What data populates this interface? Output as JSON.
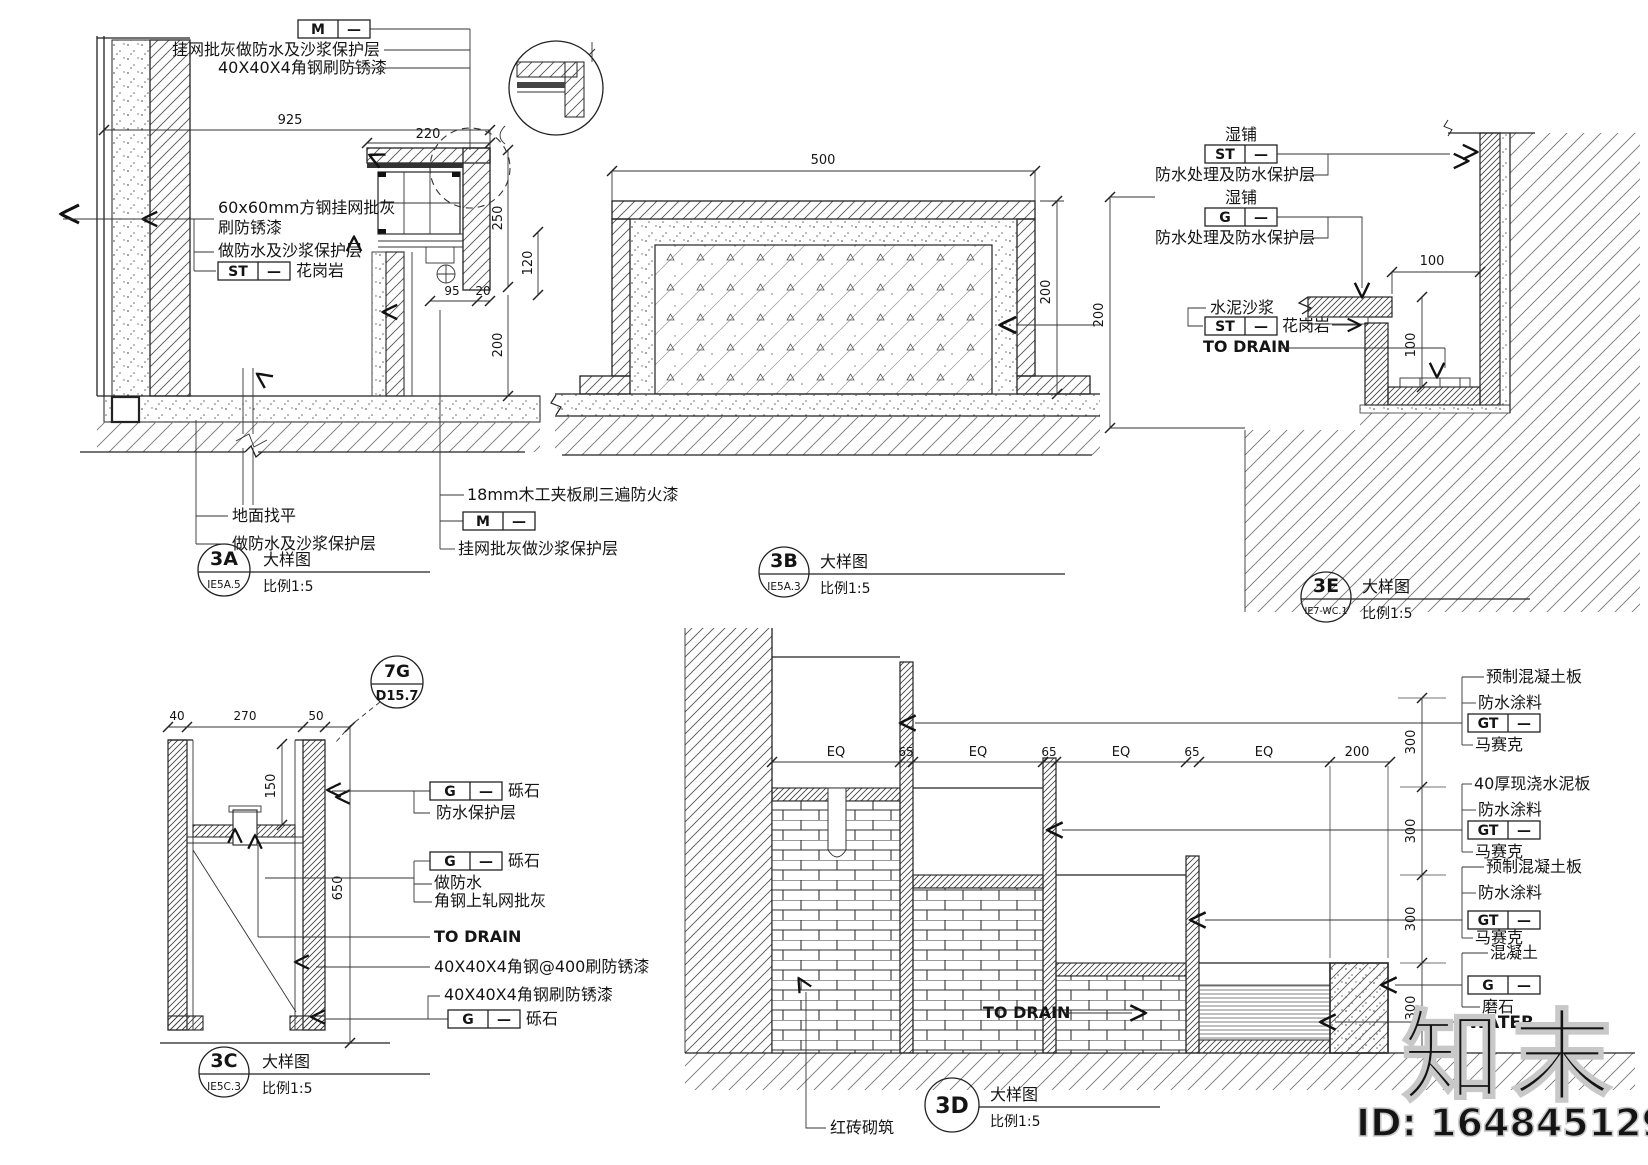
{
  "codes": {
    "m": "M",
    "st": "ST",
    "g": "G",
    "gt": "GT",
    "dash": "—"
  },
  "shared": {
    "title": "大样图",
    "scale": "比例1:5",
    "to_drain": "TO DRAIN",
    "water": "WATER"
  },
  "d3a": {
    "code": "3A",
    "ref": "IE5A.5",
    "top1": "挂网批灰做防水及沙浆保护层",
    "top2": "40X40X4角钢刷防锈漆",
    "mid1": "60x60mm方钢挂网批灰",
    "mid2": "刷防锈漆",
    "mid3": "做防水及沙浆保护层",
    "stone": "花岗岩",
    "bot1": "地面找平",
    "bot2": "做防水及沙浆保护层",
    "bot3": "18mm木工夹板刷三遍防火漆",
    "bot4": "挂网批灰做沙浆保护层",
    "d925": "925",
    "d220": "220",
    "d250": "250",
    "d120": "120",
    "d95": "95",
    "d20": "20",
    "d200": "200"
  },
  "d3b": {
    "code": "3B",
    "ref": "IE5A.3",
    "d500": "500",
    "d200": "200"
  },
  "d3e": {
    "code": "3E",
    "ref": "IE7-WC.1",
    "wet": "湿铺",
    "wp": "防水处理及防水保护层",
    "mortar": "水泥沙浆",
    "stone": "花岗岩",
    "d100w": "100",
    "d100h": "100",
    "d200": "200"
  },
  "d3c": {
    "code": "3C",
    "ref": "IE5C.3",
    "bubble_code": "7G",
    "bubble_ref": "D15.7",
    "gravel": "砾石",
    "wp": "防水保护层",
    "wf": "做防水",
    "mesh": "角钢上轧网批灰",
    "angle400": "40X40X4角钢@400刷防锈漆",
    "angle": "40X40X4角钢刷防锈漆",
    "d40": "40",
    "d270": "270",
    "d50": "50",
    "d150": "150",
    "d650": "650"
  },
  "d3d": {
    "code": "3D",
    "precast": "预制混凝土板",
    "coating": "防水涂料",
    "mosaic": "马赛克",
    "cast40": "40厚现浇水泥板",
    "concrete": "混凝土",
    "terrazzo": "磨石",
    "brick": "红砖砌筑",
    "eq": "EQ",
    "d65": "65",
    "d200": "200",
    "d300": "300"
  },
  "watermark": {
    "brand": "知末",
    "id": "ID: 164845129"
  }
}
